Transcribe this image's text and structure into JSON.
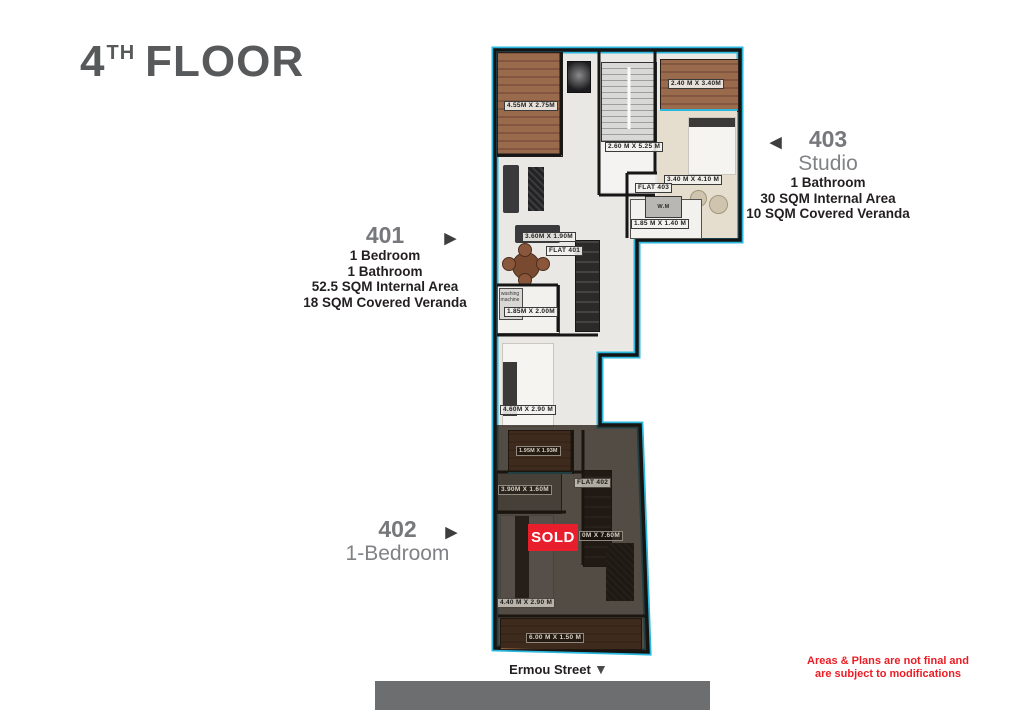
{
  "title": {
    "floor_number": "4",
    "floor_suffix": "TH",
    "floor_word": "FLOOR"
  },
  "icons": {
    "arrow_left": "◀",
    "arrow_right": "▶",
    "arrow_down": "▼"
  },
  "colors": {
    "accent_cyan": "#2bb7dc",
    "sold_red": "#e81e2c",
    "warning_red": "#ed1c24",
    "title_gray": "#58595b",
    "unit_gray": "#77787b",
    "street_gray": "#6d6e70"
  },
  "units": {
    "u401": {
      "number": "401",
      "specs": [
        "1 Bedroom",
        "1 Bathroom",
        "52.5 SQM Internal Area",
        "18 SQM Covered Veranda"
      ]
    },
    "u402": {
      "number": "402",
      "type_label": "1-Bedroom",
      "sold_label": "SOLD"
    },
    "u403": {
      "number": "403",
      "type_label": "Studio",
      "specs": [
        "1 Bathroom",
        "30 SQM Internal Area",
        "10 SQM Covered Veranda"
      ]
    }
  },
  "plan": {
    "flats": {
      "f401": "FLAT 401",
      "f402": "FLAT 402",
      "f403": "FLAT 403"
    },
    "dims": {
      "veranda_401": "4.55M X 2.75M",
      "staircase": "2.60 M X 5.25 M",
      "veranda_403": "2.40 M X 3.40M",
      "bedroom_403": "3.40 M X 4.10 M",
      "bathroom_403": "1.85 M X 1.40 M",
      "kitchen_401": "3.60M X 1.90M",
      "bathroom_401": "1.85M X 2.00M",
      "bedroom_401": "4.60M X 2.90 M",
      "veranda_402_top": "1.95M X 1.93M",
      "bathroom_402": "3.90M X 1.60M",
      "living_402": "0M X 7.60M",
      "bedroom_402": "4.40 M X 2.90 M",
      "veranda_402_bottom": "6.00 M X 1.50 M"
    },
    "appliances": {
      "wm": "W.M",
      "washing_machine": "washing machine"
    }
  },
  "street": {
    "name": "Ermou Street"
  },
  "disclaimer": {
    "line1": "Areas & Plans are not final and",
    "line2": "are subject to modifications"
  }
}
